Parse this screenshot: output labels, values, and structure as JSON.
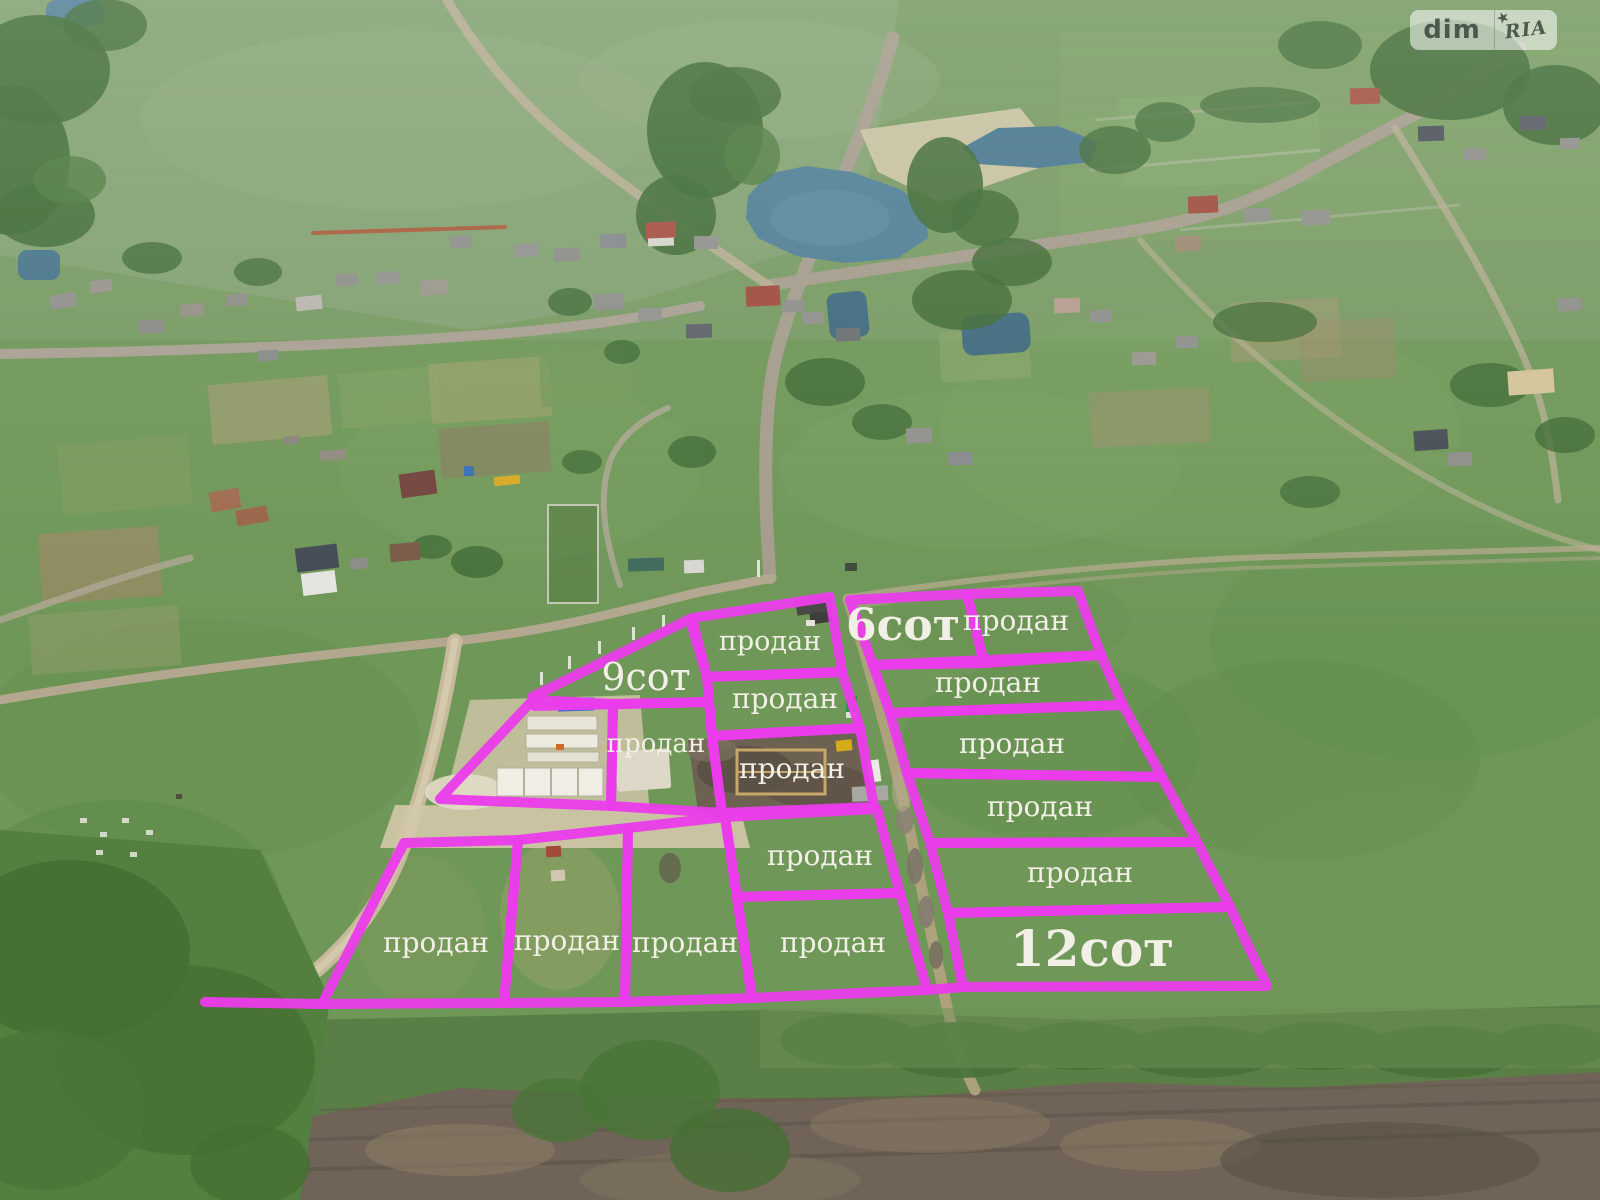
{
  "watermark": {
    "left": "dim",
    "right": "RIA",
    "star": "★"
  },
  "legend": {
    "sold_text": "продан",
    "available_plots": [
      "6сот",
      "9сот",
      "12сот"
    ]
  },
  "overlay": {
    "stroke_color": "#ea3cea",
    "label_color": "#f2efe6",
    "plots": [
      {
        "id": "sot6",
        "points": "850,600 967,594 984,663 873,665",
        "label": "6сот",
        "lx": 903,
        "ly": 640,
        "fs": 44,
        "bold": true
      },
      {
        "id": "right-1",
        "points": "967,594 1078,591 1101,655 984,663",
        "label": "продан",
        "lx": 1016,
        "ly": 630,
        "fs": 28
      },
      {
        "id": "right-2",
        "points": "873,665 1101,655 1123,705 890,713",
        "label": "продан",
        "lx": 988,
        "ly": 692,
        "fs": 28
      },
      {
        "id": "right-3",
        "points": "890,713 1123,705 1162,777 907,773",
        "label": "продан",
        "lx": 1012,
        "ly": 753,
        "fs": 28
      },
      {
        "id": "right-4",
        "points": "907,773 1162,777 1197,842 930,843",
        "label": "продан",
        "lx": 1040,
        "ly": 816,
        "fs": 28
      },
      {
        "id": "right-5",
        "points": "930,843 1197,842 1230,907 948,913",
        "label": "продан",
        "lx": 1080,
        "ly": 882,
        "fs": 28
      },
      {
        "id": "sot12",
        "points": "948,913 1230,907 1267,986 963,987",
        "label": "12сот",
        "lx": 1092,
        "ly": 966,
        "fs": 50,
        "bold": true
      },
      {
        "id": "mid-1",
        "points": "692,618 830,597 842,672 707,677",
        "label": "продан",
        "lx": 770,
        "ly": 650,
        "fs": 27
      },
      {
        "id": "mid-2",
        "points": "707,677 842,672 860,728 712,736",
        "label": "продан",
        "lx": 785,
        "ly": 708,
        "fs": 28
      },
      {
        "id": "mid-3",
        "points": "712,736 860,728 874,807 722,813",
        "label": "продан",
        "lx": 792,
        "ly": 778,
        "fs": 28
      },
      {
        "id": "mid-4",
        "points": "725,817 877,809 900,893 737,897",
        "label": "продан",
        "lx": 820,
        "ly": 865,
        "fs": 28
      },
      {
        "id": "bottom-4",
        "points": "737,897 900,893 927,990 752,998",
        "label": "продан",
        "lx": 833,
        "ly": 952,
        "fs": 28
      },
      {
        "id": "bottom-3",
        "points": "628,828 725,817 737,897 752,998 625,1002",
        "label": "продан",
        "lx": 685,
        "ly": 952,
        "fs": 28
      },
      {
        "id": "bottom-2",
        "points": "518,840 628,828 625,1002 504,1003",
        "label": "продан",
        "lx": 567,
        "ly": 950,
        "fs": 28
      },
      {
        "id": "bottom-1",
        "points": "404,843 518,840 504,1003 322,1004",
        "label": "продан",
        "lx": 436,
        "ly": 952,
        "fs": 28
      },
      {
        "id": "sot9",
        "points": "532,697 690,619 707,677 709,702 535,706",
        "label": "9сот",
        "lx": 646,
        "ly": 690,
        "fs": 38
      },
      {
        "id": "foundation-plot",
        "points": "533,700 613,704 611,806 440,799",
        "label": ""
      },
      {
        "id": "pad-plot",
        "points": "613,704 709,702 712,736 722,813 611,806",
        "label": "продан",
        "lx": 656,
        "ly": 752,
        "fs": 26
      }
    ],
    "extra_lines": [
      {
        "x1": 205,
        "y1": 1002,
        "x2": 322,
        "y2": 1004
      },
      {
        "x1": 927,
        "y1": 990,
        "x2": 963,
        "y2": 987
      }
    ]
  }
}
